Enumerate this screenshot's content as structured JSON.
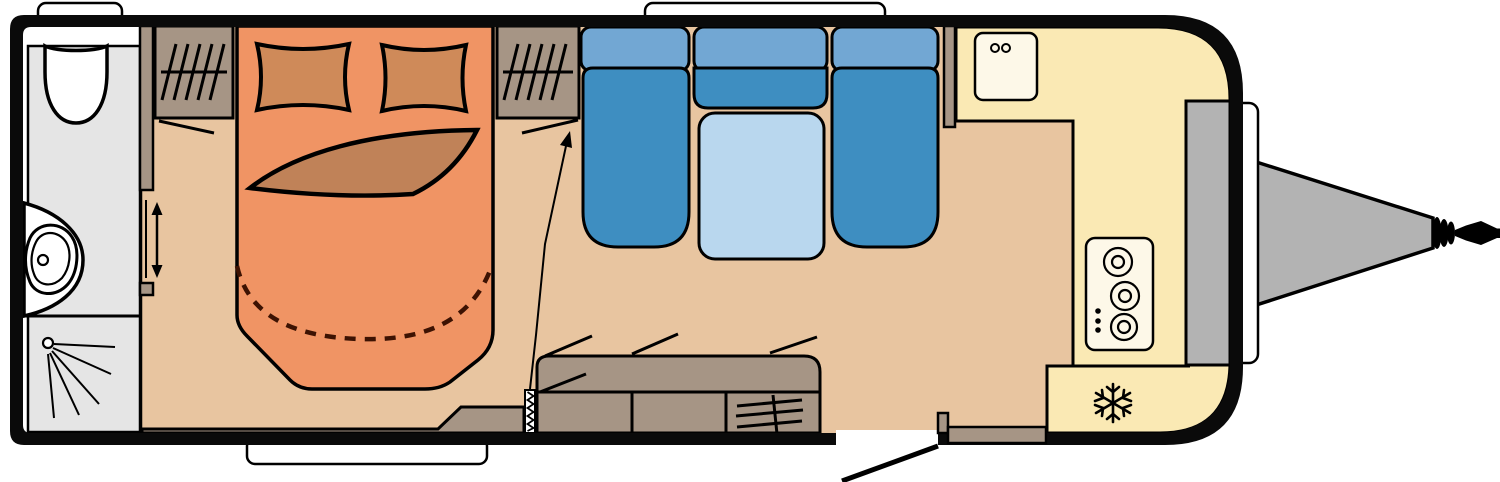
{
  "page": {
    "title": "Caravan floor plan",
    "background": "#ffffff"
  },
  "colors": {
    "page": "#ffffff",
    "outline": "#000000",
    "wall": "#0a0a0a",
    "floor": "#e8c5a0",
    "window": "#ffffff",
    "chassis": "#b3b3b3",
    "washroom": "#e5e5e5",
    "fixture": "#ffffff",
    "furniture": "#a69585",
    "bed": "#f09464",
    "pillow": "#cf8a59",
    "blanket": "#c08258",
    "bed_extension_dash": "#3d1202",
    "seat": "#3e8ec1",
    "backrest": "#72a7d3",
    "table": "#b9d7ee",
    "kitchen": "#fae9b4",
    "appliance": "#fdf8e8"
  },
  "floorplan": {
    "type": "caravan-floorplan",
    "orientation": "hitch-right",
    "areas": [
      {
        "name": "washroom",
        "features": [
          "toilet",
          "washbasin",
          "shower",
          "sliding-door"
        ]
      },
      {
        "name": "bedroom",
        "features": [
          "french-bed",
          "pillow-left",
          "pillow-right",
          "blanket",
          "wardrobe-left",
          "wardrobe-right",
          "bed-extension-dashed",
          "fold-partition-door",
          "partition-pull-arrow"
        ]
      },
      {
        "name": "lounge",
        "features": [
          "seat-left",
          "seat-right",
          "bench-middle",
          "table"
        ]
      },
      {
        "name": "kitchen",
        "features": [
          "sink",
          "hob-3-burner",
          "refrigerator",
          "partition-wall"
        ]
      },
      {
        "name": "entry",
        "features": [
          "sideboard",
          "heater",
          "entry-door",
          "door-swing",
          "step"
        ]
      },
      {
        "name": "exterior",
        "features": [
          "window-top-left",
          "window-top-middle",
          "window-bottom",
          "window-front",
          "gas-locker",
          "drawbar",
          "hitch-coupling",
          "hitch-handle"
        ]
      }
    ]
  }
}
